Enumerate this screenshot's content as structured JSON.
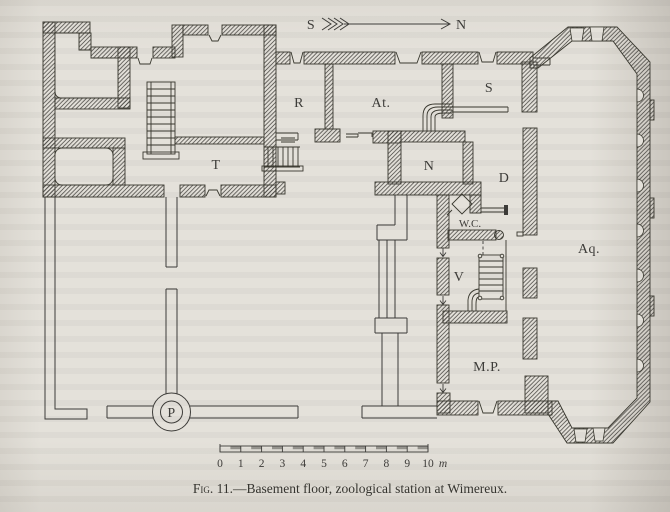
{
  "page": {
    "paper_color": "#e4e1da",
    "ink_color": "#3d3c39"
  },
  "compass": {
    "south": "S",
    "north": "N"
  },
  "rooms": {
    "t": "T",
    "r": "R",
    "atelier": "At.",
    "s": "S",
    "n": "N",
    "d": "D",
    "wc": "W.C.",
    "aquarium": "Aq.",
    "v": "V",
    "mp": "M.P.",
    "p": "P"
  },
  "scale_bar": {
    "ticks": [
      "0",
      "1",
      "2",
      "3",
      "4",
      "5",
      "6",
      "7",
      "8",
      "9",
      "10"
    ],
    "unit": "m"
  },
  "caption": {
    "fig_label": "Fig. 11.",
    "text": "—Basement floor, zoological station at Wimereux."
  }
}
